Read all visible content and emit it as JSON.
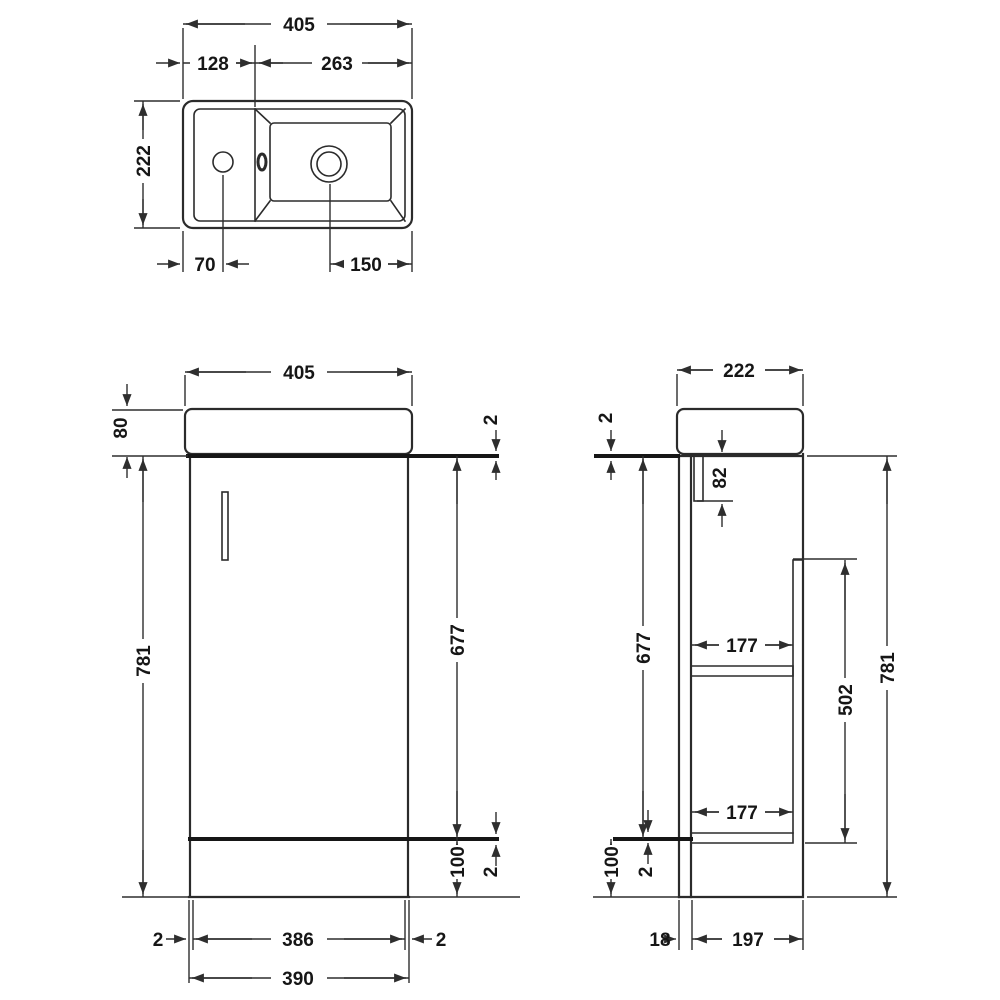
{
  "drawing": {
    "plan": {
      "overall_width": "405",
      "left_section_width": "128",
      "basin_width": "263",
      "depth": "222",
      "tap_hole_offset": "70",
      "waste_offset": "150"
    },
    "front": {
      "overall_width": "405",
      "worktop_height": "80",
      "top_gap": "2",
      "door_height": "677",
      "overall_height": "781",
      "plinth_height": "100",
      "bottom_gap": "2",
      "left_gap": "2",
      "door_width": "386",
      "right_gap": "2",
      "carcass_width": "390"
    },
    "side": {
      "depth": "222",
      "top_gap": "2",
      "rail_height": "82",
      "door_height": "677",
      "upper_shelf_depth": "177",
      "lower_shelf_depth": "177",
      "back_panel_height": "502",
      "overall_height": "781",
      "plinth_height": "100",
      "bottom_gap": "2",
      "door_thickness": "18",
      "carcass_depth": "197"
    },
    "colors": {
      "line": "#2b2b2b",
      "text": "#161616",
      "background": "#ffffff"
    }
  }
}
